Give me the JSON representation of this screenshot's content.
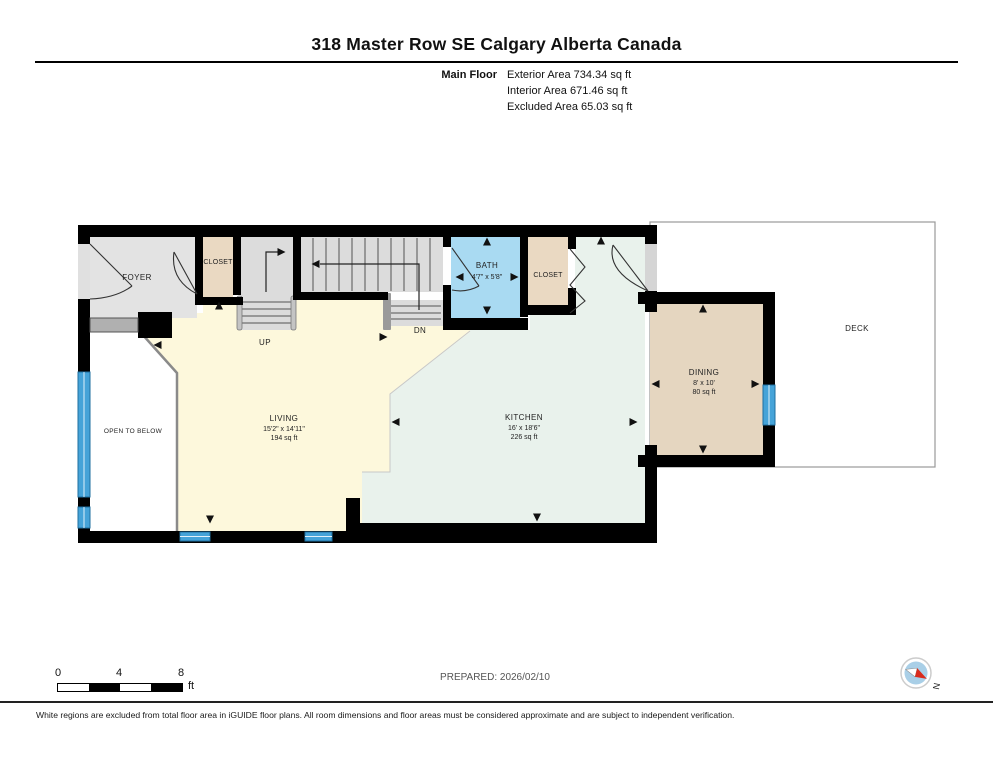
{
  "header": {
    "title": "318 Master Row SE Calgary Alberta Canada",
    "floor_label": "Main Floor",
    "area_lines": [
      "Exterior Area 734.34 sq ft",
      "Interior Area 671.46 sq ft",
      "Excluded Area 65.03 sq ft"
    ]
  },
  "rooms": {
    "foyer": {
      "name": "FOYER"
    },
    "closet_foyer": {
      "name": "CLOSET"
    },
    "closet_kitchen": {
      "name": "CLOSET"
    },
    "bath": {
      "name": "BATH",
      "dims": "4'7\" x 5'8\""
    },
    "living": {
      "name": "LIVING",
      "dims": "15'2\" x 14'11\"",
      "area": "194 sq ft"
    },
    "kitchen": {
      "name": "KITCHEN",
      "dims": "16' x 18'6\"",
      "area": "226 sq ft"
    },
    "dining": {
      "name": "DINING",
      "dims": "8' x 10'",
      "area": "80 sq ft"
    },
    "deck": {
      "name": "DECK"
    },
    "open_to_below": {
      "name": "OPEN TO BELOW"
    }
  },
  "stairs": {
    "up": "UP",
    "down": "DN"
  },
  "scale_bar": {
    "ticks": [
      "0",
      "4",
      "8"
    ],
    "unit": "ft"
  },
  "prepared": "PREPARED: 2026/02/10",
  "compass": {
    "label": "N"
  },
  "disclaimer": "White regions are excluded from total floor area in iGUIDE floor plans. All room dimensions and floor areas must be considered approximate and are subject to independent verification.",
  "colors": {
    "wall": "#000000",
    "floor_gray": "#e3e3e3",
    "closet_tan": "#ead9c2",
    "bath_blue": "#a9daf2",
    "kitchen_mint": "#e9f2ec",
    "living_cream": "#fdf8dc",
    "dining_tan": "#e5d6c0",
    "window_blue": "#45a3d8",
    "compass_blue": "#a9cfe7",
    "compass_red": "#d92b1c"
  }
}
